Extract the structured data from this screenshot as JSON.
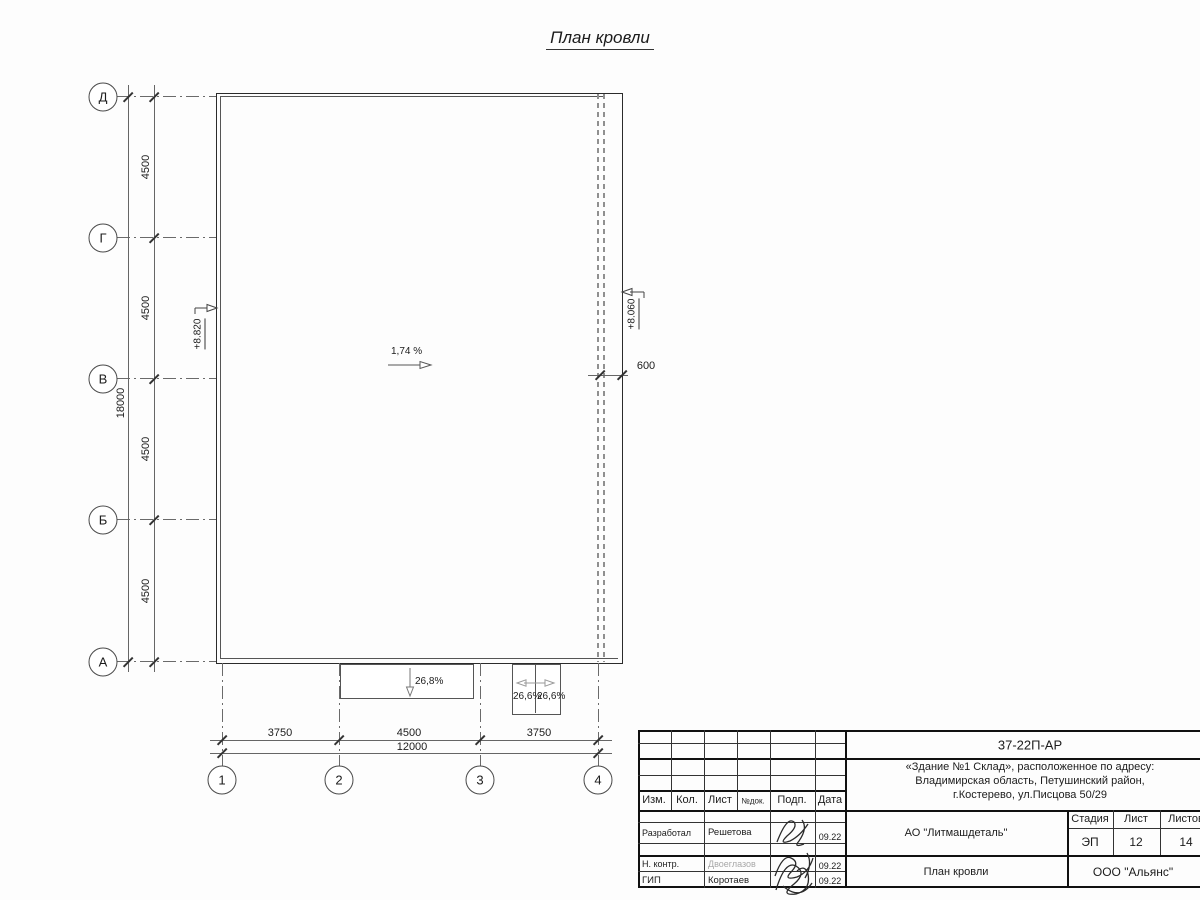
{
  "title": "План кровли",
  "grid": {
    "rows": [
      {
        "label": "Д"
      },
      {
        "label": "Г"
      },
      {
        "label": "В"
      },
      {
        "label": "Б"
      },
      {
        "label": "А"
      }
    ],
    "cols": [
      {
        "label": "1"
      },
      {
        "label": "2"
      },
      {
        "label": "3"
      },
      {
        "label": "4"
      }
    ]
  },
  "dimensions": {
    "row_spacing": [
      {
        "value": "4500"
      },
      {
        "value": "4500"
      },
      {
        "value": "4500"
      },
      {
        "value": "4500"
      }
    ],
    "row_total": "18000",
    "col_spacing": [
      {
        "value": "3750"
      },
      {
        "value": "4500"
      },
      {
        "value": "3750"
      }
    ],
    "col_total": "12000",
    "edge_offset": "600"
  },
  "annotations": {
    "main_slope": "1,74 %",
    "elev_left": "+8.820",
    "elev_right": "+8.060",
    "canopy_slope": "26,8%",
    "ramp_slope_left": "26,6%",
    "ramp_slope_right": "26,6%"
  },
  "titleblock": {
    "doc_code": "37-22П-АР",
    "address_line1": "«Здание №1 Склад», расположенное по адресу:",
    "address_line2": "Владимирская область, Петушинский район,",
    "address_line3": "г.Костерево, ул.Писцова 50/29",
    "header": {
      "izm": "Изм.",
      "kol": "Кол.",
      "list": "Лист",
      "ndok": "№док.",
      "podp": "Подп.",
      "data": "Дата"
    },
    "rows": [
      {
        "role": "Разработал",
        "name": "Решетова",
        "date": "09.22"
      },
      {
        "role": "Н. контр.",
        "name": "Двоеглазов",
        "date": "09.22"
      },
      {
        "role": "ГИП",
        "name": "Коротаев",
        "date": "09.22"
      }
    ],
    "org": "АО \"Литмашдеталь\"",
    "stage_label": "Стадия",
    "sheet_label": "Лист",
    "sheets_label": "Листов",
    "stage_value": "ЭП",
    "sheet_value": "12",
    "sheets_value": "14",
    "doc_title": "План кровли",
    "company": "ООО \"Альянс\""
  }
}
